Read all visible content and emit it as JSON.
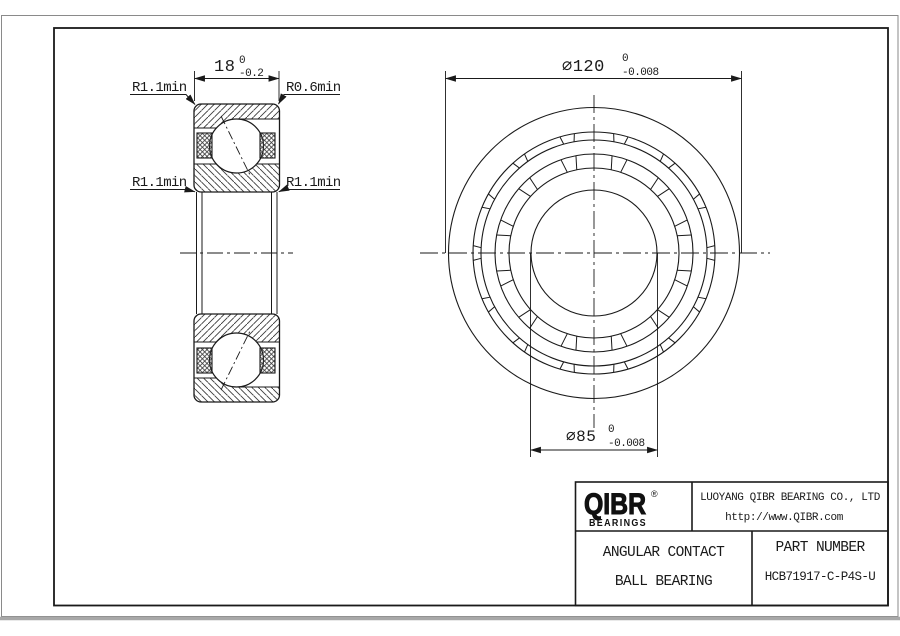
{
  "section_view": {
    "width_dim": {
      "value": "18",
      "tol_top": "0",
      "tol_bottom": "-0.2"
    },
    "radius_labels": {
      "top_left": "R1.1min",
      "top_right": "R0.6min",
      "bottom_left": "R1.1min",
      "bottom_right": "R1.1min"
    }
  },
  "front_view": {
    "outer_dia": {
      "value": "∅120",
      "tol_top": "0",
      "tol_bottom": "-0.008"
    },
    "bore_dia": {
      "value": "∅85",
      "tol_top": "0",
      "tol_bottom": "-0.008"
    }
  },
  "title_block": {
    "logo_text": "QIBR",
    "logo_mark": "®",
    "logo_sub": "BEARINGS",
    "company": "LUOYANG QIBR BEARING CO., LTD",
    "website": "http://www.QIBR.com",
    "product_name_line1": "ANGULAR CONTACT",
    "product_name_line2": "BALL BEARING",
    "part_number_label": "PART NUMBER",
    "part_number": "HCB71917-C-P4S-U"
  },
  "colors": {
    "line": "#1a1a1a",
    "page_shadow": "#a8a8a8",
    "background": "#ffffff"
  }
}
